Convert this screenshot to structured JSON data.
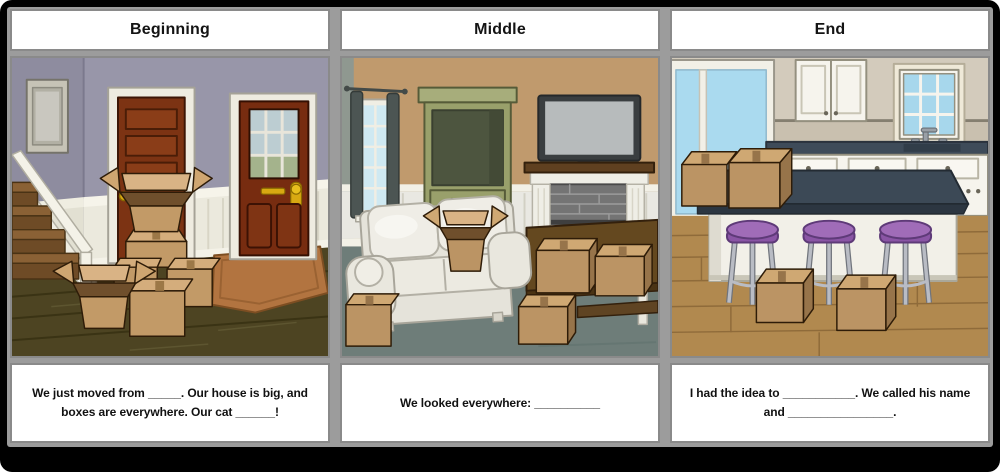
{
  "storyboard": {
    "panels": [
      {
        "id": "beginning",
        "title": "Beginning",
        "scene_name": "entry-hall-with-moving-boxes",
        "caption": "We just moved from _____. Our house is big, and boxes are everywhere. Our cat ______!"
      },
      {
        "id": "middle",
        "title": "Middle",
        "scene_name": "living-room-with-boxes",
        "caption": "We looked everywhere: __________"
      },
      {
        "id": "end",
        "title": "End",
        "scene_name": "kitchen-island-with-boxes",
        "caption": "I had the idea to ___________. We called his name and ________________."
      }
    ],
    "colors": {
      "frame_gray": "#9c9c9c",
      "cell_border": "#8a8a8a",
      "board_background": "#000000",
      "cardboard": "#c29a67",
      "stool_purple": "#a06cb8",
      "counter_slate": "#3e4b59",
      "hall_wall": "#9896a9",
      "living_wall": "#c09a6d",
      "kitchen_wall": "#d3cbbc"
    }
  }
}
